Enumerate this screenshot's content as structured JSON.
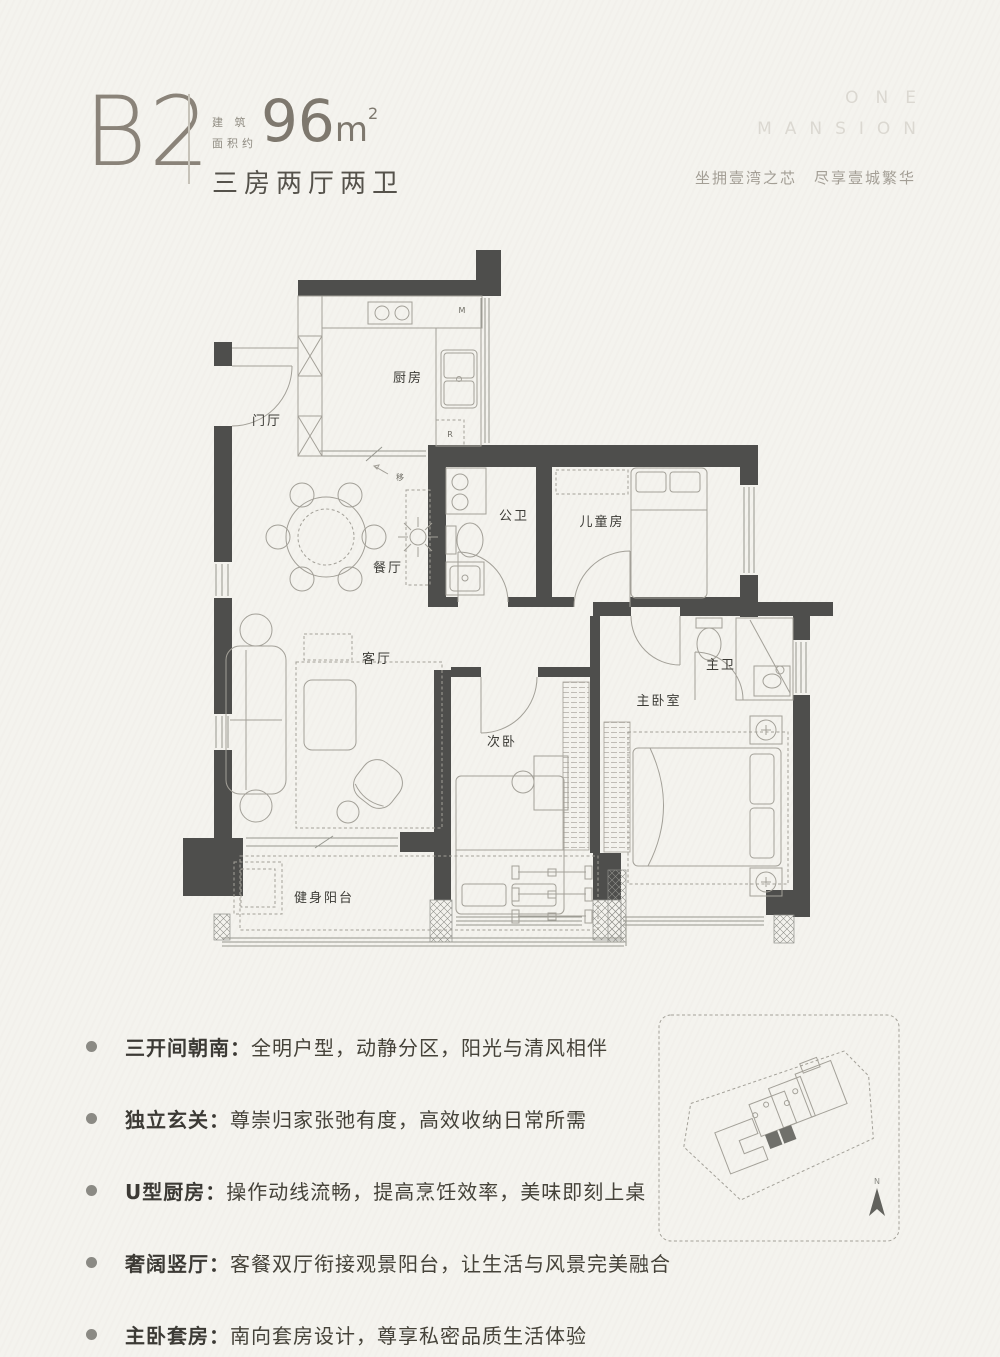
{
  "page": {
    "background": "#f4f3ee"
  },
  "header": {
    "plan_code": "B2",
    "area_prefix_line1": "建 筑",
    "area_prefix_line2": "面积约",
    "area_value": "96",
    "area_unit": "m",
    "area_sup": "2",
    "layout_desc": "三房两厅两卫"
  },
  "brand": {
    "line1": "ONE",
    "line2": "MANSION",
    "tagline": "坐拥壹湾之芯　尽享壹城繁华"
  },
  "floorplan": {
    "wall_color": "#4e4e4c",
    "rooms": [
      {
        "id": "entry",
        "label": "门厅"
      },
      {
        "id": "kitchen",
        "label": "厨房"
      },
      {
        "id": "dining",
        "label": "餐厅"
      },
      {
        "id": "living",
        "label": "客厅"
      },
      {
        "id": "guest-bath",
        "label": "公卫"
      },
      {
        "id": "kids-room",
        "label": "儿童房"
      },
      {
        "id": "master-bath",
        "label": "主卫"
      },
      {
        "id": "master-bedroom",
        "label": "主卧室"
      },
      {
        "id": "second-bedroom",
        "label": "次卧"
      },
      {
        "id": "fitness-balcony",
        "label": "健身阳台"
      }
    ],
    "annotations": {
      "sliding_door": "移",
      "fridge": "R",
      "appliance": "M"
    }
  },
  "features": [
    {
      "title": "三开间朝南：",
      "desc": "全明户型，动静分区，阳光与清风相伴"
    },
    {
      "title": "独立玄关：",
      "desc": "尊崇归家张弛有度，高效收纳日常所需"
    },
    {
      "title": "U型厨房：",
      "desc": "操作动线流畅，提高烹饪效率，美味即刻上桌"
    },
    {
      "title": "奢阔竖厅：",
      "desc": "客餐双厅衔接观景阳台，让生活与风景完美融合"
    },
    {
      "title": "主卧套房：",
      "desc": "南向套房设计，尊享私密品质生活体验"
    }
  ],
  "siteplan": {
    "north_label": "N"
  }
}
